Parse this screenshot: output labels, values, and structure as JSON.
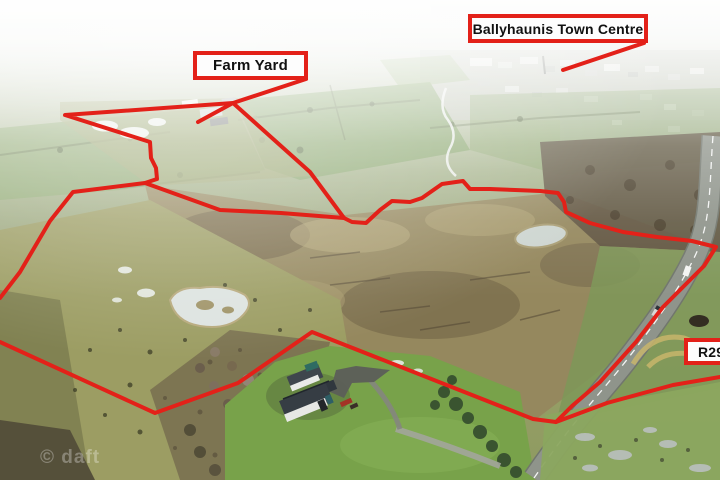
{
  "page": {
    "description": "Aerial drone photograph of farmland outside Ballyhaunis with property boundary outlined in red",
    "boundary_color": "#e32119",
    "callout_background": "#fdfdfd",
    "callout_text_color": "#111111"
  },
  "annotations": {
    "farm_yard_label": "Farm Yard",
    "town_centre_label": "Ballyhaunis Town Centre",
    "road_label": "R29"
  },
  "watermark": {
    "text": "© daft"
  }
}
